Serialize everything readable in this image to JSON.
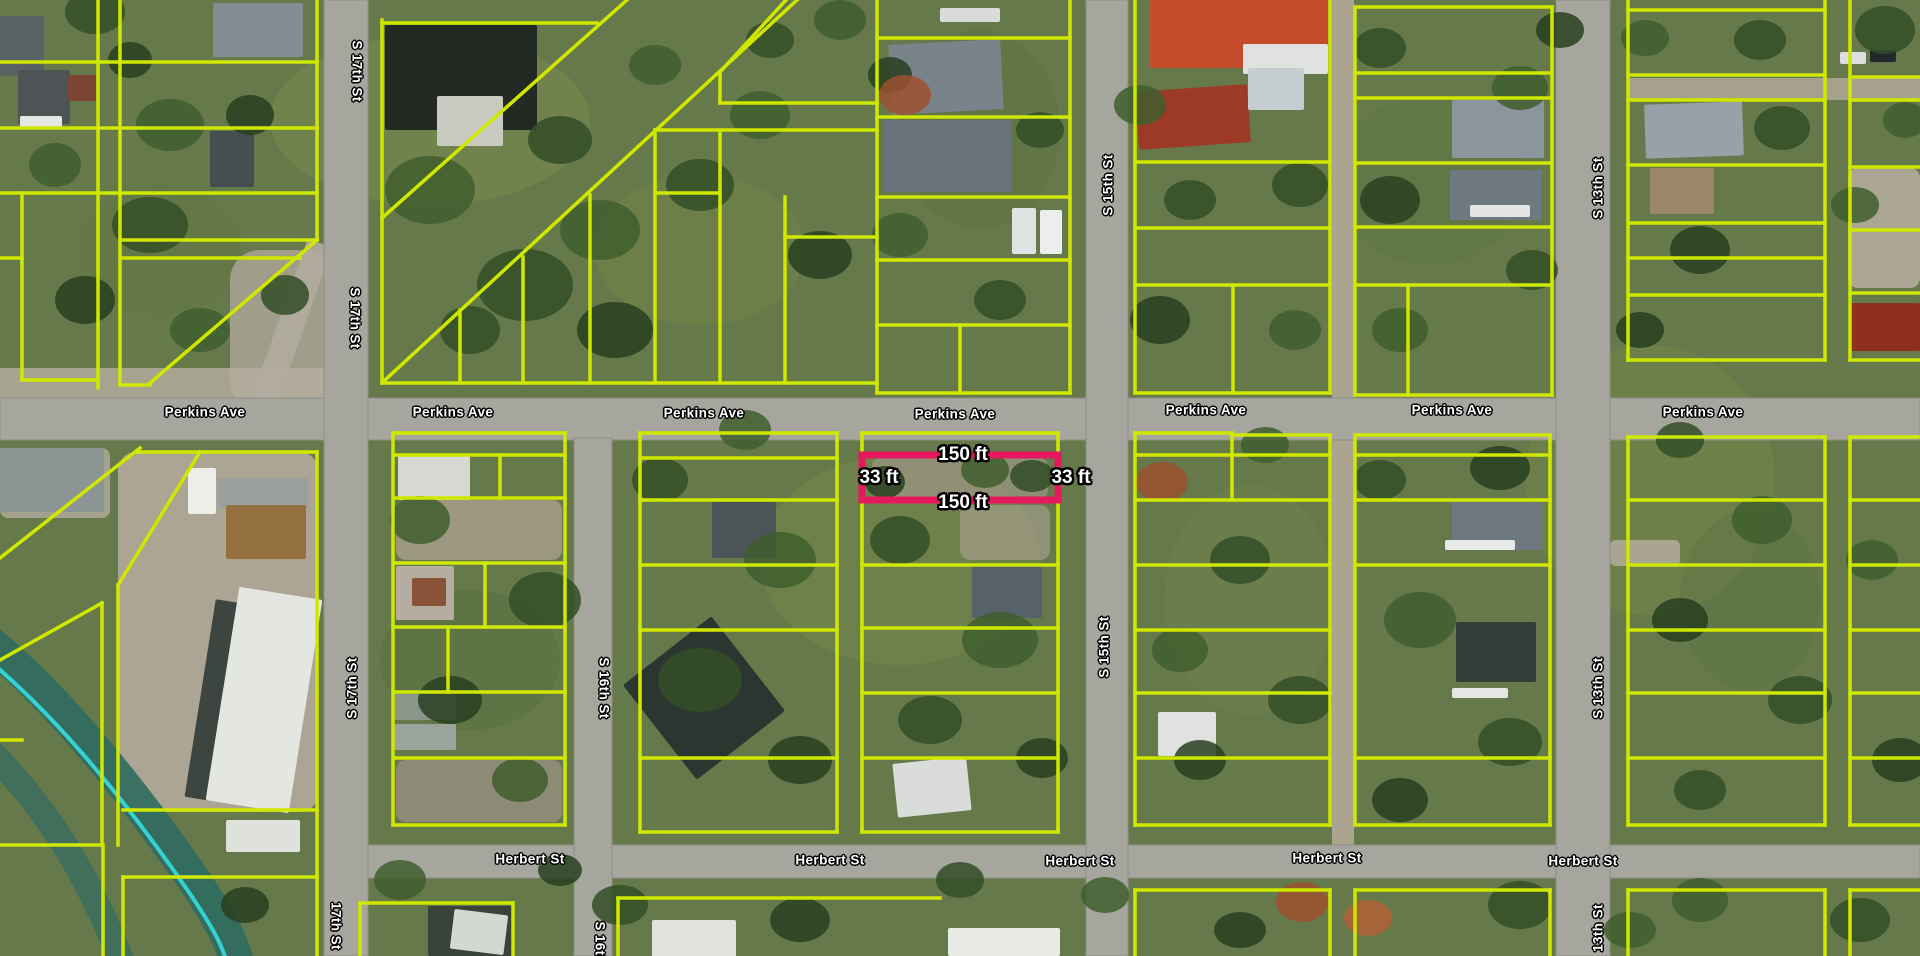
{
  "map": {
    "colors": {
      "parcel_line": "#d0e800",
      "highlight_outline": "#e6195e",
      "label_text": "#ffffff",
      "road_fill": "#a6a69e"
    },
    "street_labels": [
      {
        "text": "Perkins Ave",
        "x": 205,
        "y": 412,
        "rot": 0
      },
      {
        "text": "Perkins Ave",
        "x": 453,
        "y": 412,
        "rot": 0
      },
      {
        "text": "Perkins Ave",
        "x": 704,
        "y": 413,
        "rot": 0
      },
      {
        "text": "Perkins Ave",
        "x": 955,
        "y": 414,
        "rot": 0
      },
      {
        "text": "Perkins Ave",
        "x": 1206,
        "y": 410,
        "rot": 0
      },
      {
        "text": "Perkins Ave",
        "x": 1452,
        "y": 410,
        "rot": 0
      },
      {
        "text": "Perkins Ave",
        "x": 1703,
        "y": 412,
        "rot": 0
      },
      {
        "text": "Herbert St",
        "x": 530,
        "y": 859,
        "rot": 0
      },
      {
        "text": "Herbert St",
        "x": 830,
        "y": 860,
        "rot": 0
      },
      {
        "text": "Herbert St",
        "x": 1080,
        "y": 861,
        "rot": 0
      },
      {
        "text": "Herbert St",
        "x": 1327,
        "y": 858,
        "rot": 0
      },
      {
        "text": "Herbert St",
        "x": 1583,
        "y": 861,
        "rot": 0
      },
      {
        "text": "S 17th St",
        "x": 357,
        "y": 71,
        "rot": 90
      },
      {
        "text": "S 17th St",
        "x": 355,
        "y": 318,
        "rot": 90
      },
      {
        "text": "S 17th St",
        "x": 352,
        "y": 688,
        "rot": -90
      },
      {
        "text": "17th St",
        "x": 336,
        "y": 926,
        "rot": 90
      },
      {
        "text": "S 16th St",
        "x": 604,
        "y": 688,
        "rot": 90
      },
      {
        "text": "S 16th St",
        "x": 600,
        "y": 952,
        "rot": 90
      },
      {
        "text": "S 15th St",
        "x": 1108,
        "y": 185,
        "rot": -90
      },
      {
        "text": "S 15th St",
        "x": 1104,
        "y": 647,
        "rot": -90
      },
      {
        "text": "S 13th St",
        "x": 1598,
        "y": 188,
        "rot": -90
      },
      {
        "text": "S 13th St",
        "x": 1598,
        "y": 688,
        "rot": -90
      },
      {
        "text": "13th St",
        "x": 1598,
        "y": 928,
        "rot": -90
      }
    ],
    "highlight": {
      "x": 862,
      "y": 455,
      "w": 196,
      "h": 45,
      "dimension_labels": [
        {
          "text": "150 ft",
          "x": 963,
          "y": 455
        },
        {
          "text": "150 ft",
          "x": 963,
          "y": 503
        },
        {
          "text": "33 ft",
          "x": 879,
          "y": 478
        },
        {
          "text": "33 ft",
          "x": 1071,
          "y": 478
        }
      ]
    },
    "roads": [
      {
        "name": "perkins-ave",
        "x": 0,
        "y": 398,
        "w": 1920,
        "h": 42
      },
      {
        "name": "herbert-st",
        "x": 340,
        "y": 845,
        "w": 1580,
        "h": 33
      },
      {
        "name": "s-17th-st",
        "x": 324,
        "y": 0,
        "w": 44,
        "h": 956
      },
      {
        "name": "s-16th-st",
        "x": 574,
        "y": 438,
        "w": 38,
        "h": 518
      },
      {
        "name": "s-15th-st",
        "x": 1086,
        "y": 0,
        "w": 42,
        "h": 956
      },
      {
        "name": "s-13th-st",
        "x": 1556,
        "y": 0,
        "w": 54,
        "h": 956
      }
    ],
    "parcel_lines": [
      [
        98,
        0,
        98,
        388
      ],
      [
        120,
        0,
        120,
        385
      ],
      [
        317,
        0,
        317,
        240
      ],
      [
        22,
        193,
        22,
        380
      ],
      [
        0,
        62,
        317,
        62
      ],
      [
        0,
        128,
        317,
        128
      ],
      [
        0,
        193,
        317,
        193
      ],
      [
        0,
        258,
        22,
        258
      ],
      [
        22,
        380,
        98,
        380
      ],
      [
        120,
        240,
        317,
        240
      ],
      [
        120,
        258,
        300,
        258
      ],
      [
        317,
        240,
        150,
        383
      ],
      [
        120,
        385,
        150,
        385
      ],
      [
        382,
        20,
        382,
        383
      ],
      [
        382,
        23,
        597,
        23
      ],
      [
        382,
        383,
        877,
        383
      ],
      [
        627,
        0,
        382,
        218
      ],
      [
        797,
        0,
        385,
        380
      ],
      [
        786,
        0,
        720,
        72
      ],
      [
        720,
        72,
        720,
        103
      ],
      [
        720,
        103,
        877,
        103
      ],
      [
        655,
        130,
        877,
        130
      ],
      [
        655,
        130,
        655,
        383
      ],
      [
        720,
        130,
        720,
        383
      ],
      [
        655,
        193,
        720,
        193
      ],
      [
        590,
        195,
        590,
        383
      ],
      [
        785,
        197,
        785,
        383
      ],
      [
        785,
        237,
        877,
        237
      ],
      [
        460,
        310,
        460,
        383
      ],
      [
        523,
        257,
        523,
        383
      ],
      [
        877,
        0,
        877,
        393
      ],
      [
        1070,
        0,
        1070,
        393
      ],
      [
        877,
        38,
        1070,
        38
      ],
      [
        877,
        117,
        1070,
        117
      ],
      [
        877,
        197,
        1070,
        197
      ],
      [
        877,
        260,
        1070,
        260
      ],
      [
        877,
        325,
        1070,
        325
      ],
      [
        877,
        393,
        1070,
        393
      ],
      [
        960,
        325,
        960,
        393
      ],
      [
        1135,
        0,
        1135,
        393
      ],
      [
        1330,
        0,
        1330,
        393
      ],
      [
        1135,
        162,
        1330,
        162
      ],
      [
        1135,
        228,
        1330,
        228
      ],
      [
        1135,
        285,
        1330,
        285
      ],
      [
        1135,
        393,
        1330,
        393
      ],
      [
        1233,
        285,
        1233,
        393
      ],
      [
        1355,
        7,
        1355,
        395
      ],
      [
        1552,
        7,
        1552,
        395
      ],
      [
        1355,
        7,
        1552,
        7
      ],
      [
        1355,
        73,
        1552,
        73
      ],
      [
        1355,
        98,
        1552,
        98
      ],
      [
        1355,
        163,
        1552,
        163
      ],
      [
        1355,
        227,
        1552,
        227
      ],
      [
        1355,
        285,
        1552,
        285
      ],
      [
        1355,
        395,
        1552,
        395
      ],
      [
        1408,
        285,
        1408,
        395
      ],
      [
        1628,
        0,
        1628,
        360
      ],
      [
        1825,
        0,
        1825,
        360
      ],
      [
        1628,
        10,
        1825,
        10
      ],
      [
        1628,
        75,
        1825,
        75
      ],
      [
        1628,
        100,
        1825,
        100
      ],
      [
        1628,
        165,
        1825,
        165
      ],
      [
        1628,
        223,
        1825,
        223
      ],
      [
        1628,
        258,
        1825,
        258
      ],
      [
        1628,
        295,
        1825,
        295
      ],
      [
        1628,
        360,
        1825,
        360
      ],
      [
        1850,
        0,
        1850,
        360
      ],
      [
        1850,
        77,
        1920,
        77
      ],
      [
        1850,
        100,
        1920,
        100
      ],
      [
        1850,
        167,
        1920,
        167
      ],
      [
        1850,
        230,
        1920,
        230
      ],
      [
        1850,
        293,
        1920,
        293
      ],
      [
        1850,
        360,
        1920,
        360
      ],
      [
        0,
        558,
        140,
        448
      ],
      [
        137,
        452,
        317,
        452
      ],
      [
        317,
        452,
        317,
        956
      ],
      [
        200,
        452,
        118,
        585
      ],
      [
        118,
        585,
        118,
        845
      ],
      [
        102,
        603,
        102,
        845
      ],
      [
        0,
        660,
        102,
        603
      ],
      [
        123,
        810,
        317,
        810
      ],
      [
        123,
        877,
        317,
        877
      ],
      [
        0,
        845,
        102,
        845
      ],
      [
        103,
        845,
        103,
        956
      ],
      [
        123,
        877,
        123,
        956
      ],
      [
        0,
        740,
        22,
        740
      ],
      [
        393,
        433,
        393,
        825
      ],
      [
        565,
        433,
        565,
        825
      ],
      [
        393,
        433,
        565,
        433
      ],
      [
        393,
        455,
        565,
        455
      ],
      [
        393,
        498,
        565,
        498
      ],
      [
        393,
        563,
        565,
        563
      ],
      [
        393,
        627,
        565,
        627
      ],
      [
        393,
        692,
        565,
        692
      ],
      [
        393,
        758,
        565,
        758
      ],
      [
        393,
        825,
        565,
        825
      ],
      [
        500,
        455,
        500,
        498
      ],
      [
        485,
        563,
        485,
        627
      ],
      [
        448,
        627,
        448,
        692
      ],
      [
        640,
        433,
        640,
        832
      ],
      [
        837,
        433,
        837,
        832
      ],
      [
        640,
        433,
        837,
        433
      ],
      [
        640,
        458,
        837,
        458
      ],
      [
        640,
        500,
        837,
        500
      ],
      [
        640,
        565,
        837,
        565
      ],
      [
        640,
        630,
        837,
        630
      ],
      [
        640,
        758,
        837,
        758
      ],
      [
        640,
        832,
        837,
        832
      ],
      [
        862,
        433,
        862,
        832
      ],
      [
        1058,
        433,
        1058,
        832
      ],
      [
        862,
        433,
        1058,
        433
      ],
      [
        862,
        565,
        1058,
        565
      ],
      [
        862,
        628,
        1058,
        628
      ],
      [
        862,
        693,
        1058,
        693
      ],
      [
        862,
        758,
        1058,
        758
      ],
      [
        862,
        832,
        1058,
        832
      ],
      [
        1135,
        433,
        1135,
        825
      ],
      [
        1330,
        435,
        1330,
        825
      ],
      [
        1135,
        433,
        1232,
        433
      ],
      [
        1232,
        435,
        1330,
        435
      ],
      [
        1135,
        455,
        1330,
        455
      ],
      [
        1135,
        500,
        1330,
        500
      ],
      [
        1135,
        565,
        1330,
        565
      ],
      [
        1135,
        630,
        1330,
        630
      ],
      [
        1135,
        693,
        1330,
        693
      ],
      [
        1135,
        758,
        1330,
        758
      ],
      [
        1135,
        825,
        1330,
        825
      ],
      [
        1232,
        433,
        1232,
        500
      ],
      [
        1355,
        435,
        1355,
        825
      ],
      [
        1550,
        435,
        1550,
        825
      ],
      [
        1355,
        435,
        1550,
        435
      ],
      [
        1355,
        455,
        1550,
        455
      ],
      [
        1355,
        500,
        1550,
        500
      ],
      [
        1355,
        565,
        1550,
        565
      ],
      [
        1355,
        758,
        1550,
        758
      ],
      [
        1355,
        825,
        1550,
        825
      ],
      [
        1628,
        437,
        1628,
        825
      ],
      [
        1825,
        437,
        1825,
        825
      ],
      [
        1628,
        437,
        1825,
        437
      ],
      [
        1628,
        500,
        1825,
        500
      ],
      [
        1628,
        565,
        1825,
        565
      ],
      [
        1628,
        630,
        1825,
        630
      ],
      [
        1628,
        693,
        1825,
        693
      ],
      [
        1628,
        758,
        1825,
        758
      ],
      [
        1628,
        825,
        1825,
        825
      ],
      [
        1850,
        437,
        1850,
        825
      ],
      [
        1850,
        437,
        1920,
        437
      ],
      [
        1850,
        500,
        1920,
        500
      ],
      [
        1850,
        565,
        1920,
        565
      ],
      [
        1850,
        630,
        1920,
        630
      ],
      [
        1850,
        693,
        1920,
        693
      ],
      [
        1850,
        758,
        1920,
        758
      ],
      [
        1850,
        825,
        1920,
        825
      ],
      [
        360,
        903,
        513,
        903
      ],
      [
        360,
        903,
        360,
        956
      ],
      [
        513,
        903,
        513,
        956
      ],
      [
        618,
        898,
        940,
        898
      ],
      [
        618,
        898,
        618,
        956
      ],
      [
        1135,
        890,
        1135,
        956
      ],
      [
        1330,
        890,
        1330,
        956
      ],
      [
        1135,
        890,
        1330,
        890
      ],
      [
        1355,
        890,
        1355,
        956
      ],
      [
        1550,
        890,
        1550,
        956
      ],
      [
        1355,
        890,
        1550,
        890
      ],
      [
        1628,
        890,
        1628,
        956
      ],
      [
        1628,
        890,
        1825,
        890
      ],
      [
        1825,
        890,
        1825,
        956
      ],
      [
        1850,
        890,
        1850,
        956
      ],
      [
        1850,
        890,
        1920,
        890
      ]
    ]
  }
}
